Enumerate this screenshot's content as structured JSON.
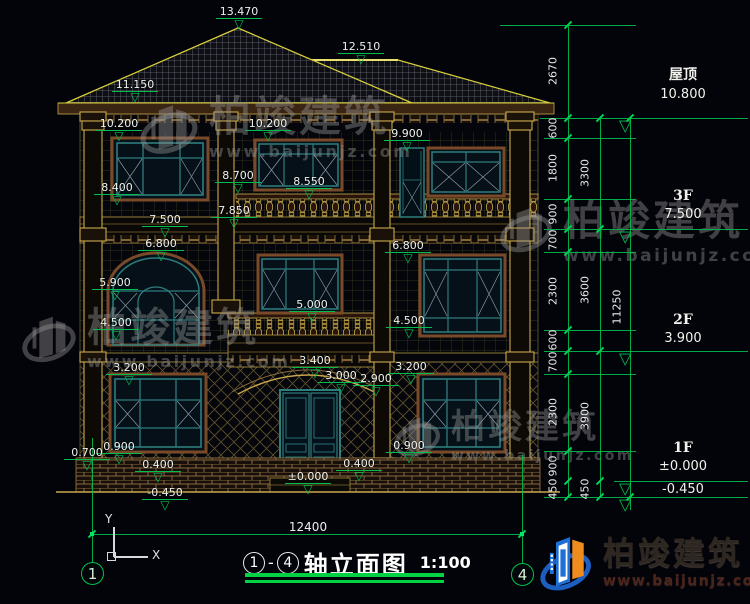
{
  "title_block": {
    "axis_start": "1",
    "axis_end": "4",
    "separator": "-",
    "title": "轴立面图",
    "scale": "1:100"
  },
  "bottom": {
    "overall_dim": "12400"
  },
  "axes": {
    "left_bubble": "1",
    "right_bubble": "4"
  },
  "ucs": {
    "x_label": "X",
    "y_label": "Y"
  },
  "watermark": {
    "brand": "柏竣建筑",
    "url": "www.baijunjz.com"
  },
  "logo": {
    "brand": "柏竣建筑",
    "url": "www.baijunjz.com"
  },
  "annotations": {
    "elevation_markers": [
      {
        "label": "13.470",
        "x": 214,
        "y": 6
      },
      {
        "label": "12.510",
        "x": 336,
        "y": 41
      },
      {
        "label": "11.150",
        "x": 110,
        "y": 79
      },
      {
        "label": "10.200",
        "x": 94,
        "y": 118
      },
      {
        "label": "10.200",
        "x": 243,
        "y": 118
      },
      {
        "label": "9.900",
        "x": 382,
        "y": 128
      },
      {
        "label": "8.700",
        "x": 213,
        "y": 170
      },
      {
        "label": "8.550",
        "x": 284,
        "y": 176
      },
      {
        "label": "8.400",
        "x": 92,
        "y": 182
      },
      {
        "label": "7.850",
        "x": 209,
        "y": 205
      },
      {
        "label": "7.500",
        "x": 140,
        "y": 214
      },
      {
        "label": "6.800",
        "x": 136,
        "y": 238
      },
      {
        "label": "6.800",
        "x": 383,
        "y": 240
      },
      {
        "label": "5.900",
        "x": 90,
        "y": 277
      },
      {
        "label": "5.000",
        "x": 287,
        "y": 299
      },
      {
        "label": "4.500",
        "x": 91,
        "y": 317
      },
      {
        "label": "4.500",
        "x": 384,
        "y": 315
      },
      {
        "label": "3.400",
        "x": 290,
        "y": 355
      },
      {
        "label": "3.200",
        "x": 104,
        "y": 362
      },
      {
        "label": "3.200",
        "x": 386,
        "y": 361
      },
      {
        "label": "3.000",
        "x": 316,
        "y": 370
      },
      {
        "label": "2.900",
        "x": 351,
        "y": 373
      },
      {
        "label": "0.900",
        "x": 94,
        "y": 441
      },
      {
        "label": "0.900",
        "x": 384,
        "y": 440
      },
      {
        "label": "0.700",
        "x": 62,
        "y": 447
      },
      {
        "label": "0.400",
        "x": 133,
        "y": 459
      },
      {
        "label": "0.400",
        "x": 334,
        "y": 458
      },
      {
        "label": "±0.000",
        "x": 283,
        "y": 471
      },
      {
        "label": "-0.450",
        "x": 140,
        "y": 487
      }
    ],
    "dim_texts": [
      {
        "value": "2670",
        "x": 553,
        "y": 71
      },
      {
        "value": "600",
        "x": 553,
        "y": 128
      },
      {
        "value": "1800",
        "x": 553,
        "y": 168
      },
      {
        "value": "900",
        "x": 553,
        "y": 214
      },
      {
        "value": "700",
        "x": 553,
        "y": 240
      },
      {
        "value": "2300",
        "x": 553,
        "y": 291
      },
      {
        "value": "600",
        "x": 553,
        "y": 340
      },
      {
        "value": "700",
        "x": 553,
        "y": 362
      },
      {
        "value": "2300",
        "x": 553,
        "y": 412
      },
      {
        "value": "900",
        "x": 553,
        "y": 466
      },
      {
        "value": "450",
        "x": 553,
        "y": 489
      },
      {
        "value": "3300",
        "x": 585,
        "y": 173
      },
      {
        "value": "3600",
        "x": 585,
        "y": 290
      },
      {
        "value": "3900",
        "x": 585,
        "y": 416
      },
      {
        "value": "450",
        "x": 585,
        "y": 489
      },
      {
        "value": "11250",
        "x": 617,
        "y": 307
      }
    ],
    "chain_ticks": [
      {
        "x": 568,
        "ys": [
          25,
          118,
          138,
          199,
          229,
          252,
          330,
          351,
          374,
          451,
          481,
          497
        ]
      },
      {
        "x": 600,
        "ys": [
          118,
          229,
          351,
          481,
          497
        ]
      },
      {
        "x": 630,
        "ys": [
          118,
          497
        ]
      }
    ],
    "ext_lines": [
      {
        "y": 25,
        "x1": 500,
        "x2": 636
      },
      {
        "y": 118,
        "x1": 540,
        "x2": 748
      },
      {
        "y": 138,
        "x1": 544,
        "x2": 636
      },
      {
        "y": 199,
        "x1": 544,
        "x2": 636
      },
      {
        "y": 229,
        "x1": 544,
        "x2": 748
      },
      {
        "y": 252,
        "x1": 544,
        "x2": 636
      },
      {
        "y": 330,
        "x1": 544,
        "x2": 636
      },
      {
        "y": 351,
        "x1": 544,
        "x2": 748
      },
      {
        "y": 374,
        "x1": 544,
        "x2": 636
      },
      {
        "y": 451,
        "x1": 544,
        "x2": 636
      },
      {
        "y": 481,
        "x1": 614,
        "x2": 748
      },
      {
        "y": 497,
        "x1": 544,
        "x2": 748
      }
    ],
    "level_triangles": [
      {
        "x": 619,
        "y": 119
      },
      {
        "x": 619,
        "y": 230
      },
      {
        "x": 619,
        "y": 352
      },
      {
        "x": 619,
        "y": 482
      },
      {
        "x": 619,
        "y": 498
      }
    ],
    "right_levels": [
      {
        "name": "屋顶",
        "elev": "10.800",
        "x": 628,
        "y": 64
      },
      {
        "name": "3F",
        "elev": "7.500",
        "x": 628,
        "y": 188
      },
      {
        "name": "2F",
        "elev": "3.900",
        "x": 628,
        "y": 312
      },
      {
        "name": "1F",
        "elev": "±0.000",
        "sub": "-0.450",
        "x": 628,
        "y": 440
      }
    ]
  }
}
